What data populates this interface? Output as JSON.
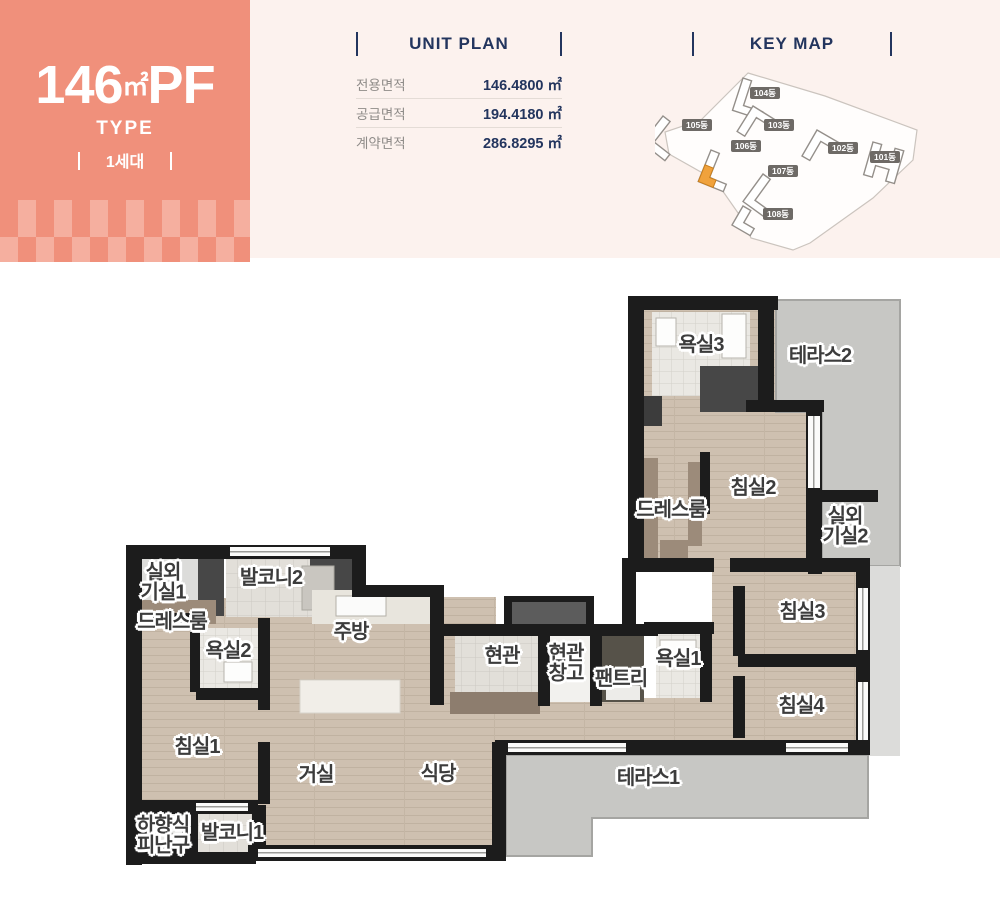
{
  "type_card": {
    "area": "146",
    "area_unit": "㎡",
    "suffix": "PF",
    "type_label": "TYPE",
    "units_label": "1세대",
    "bg_color": "#F0907B",
    "checker_color": "#F5AF9F"
  },
  "unit_plan": {
    "title": "UNIT PLAN",
    "rows": [
      {
        "label": "전용면적",
        "value": "146.4800 ㎡"
      },
      {
        "label": "공급면적",
        "value": "194.4180 ㎡"
      },
      {
        "label": "계약면적",
        "value": "286.8295 ㎡"
      }
    ]
  },
  "key_map": {
    "title": "KEY MAP",
    "highlight_color": "#F0A23C",
    "highlighted_building": "106동",
    "buildings": [
      "104동",
      "105동",
      "103동",
      "106동",
      "102동",
      "101동",
      "107동",
      "108동"
    ]
  },
  "floorplan": {
    "accent_navy": "#23355E",
    "wall_color": "#1C1C1C",
    "wood_color": "#CEC0B0",
    "terrace_color": "#C7C7C4",
    "rooms": [
      "욕실3",
      "테라스2",
      "침실2",
      "드레스룸",
      "실외\n기실2",
      "실외\n기실1",
      "발코니2",
      "드레스룸",
      "욕실2",
      "주방",
      "현관",
      "현관\n창고",
      "팬트리",
      "욕실1",
      "침실3",
      "침실4",
      "침실1",
      "거실",
      "식당",
      "테라스1",
      "하향식\n피난구",
      "발코니1"
    ]
  }
}
